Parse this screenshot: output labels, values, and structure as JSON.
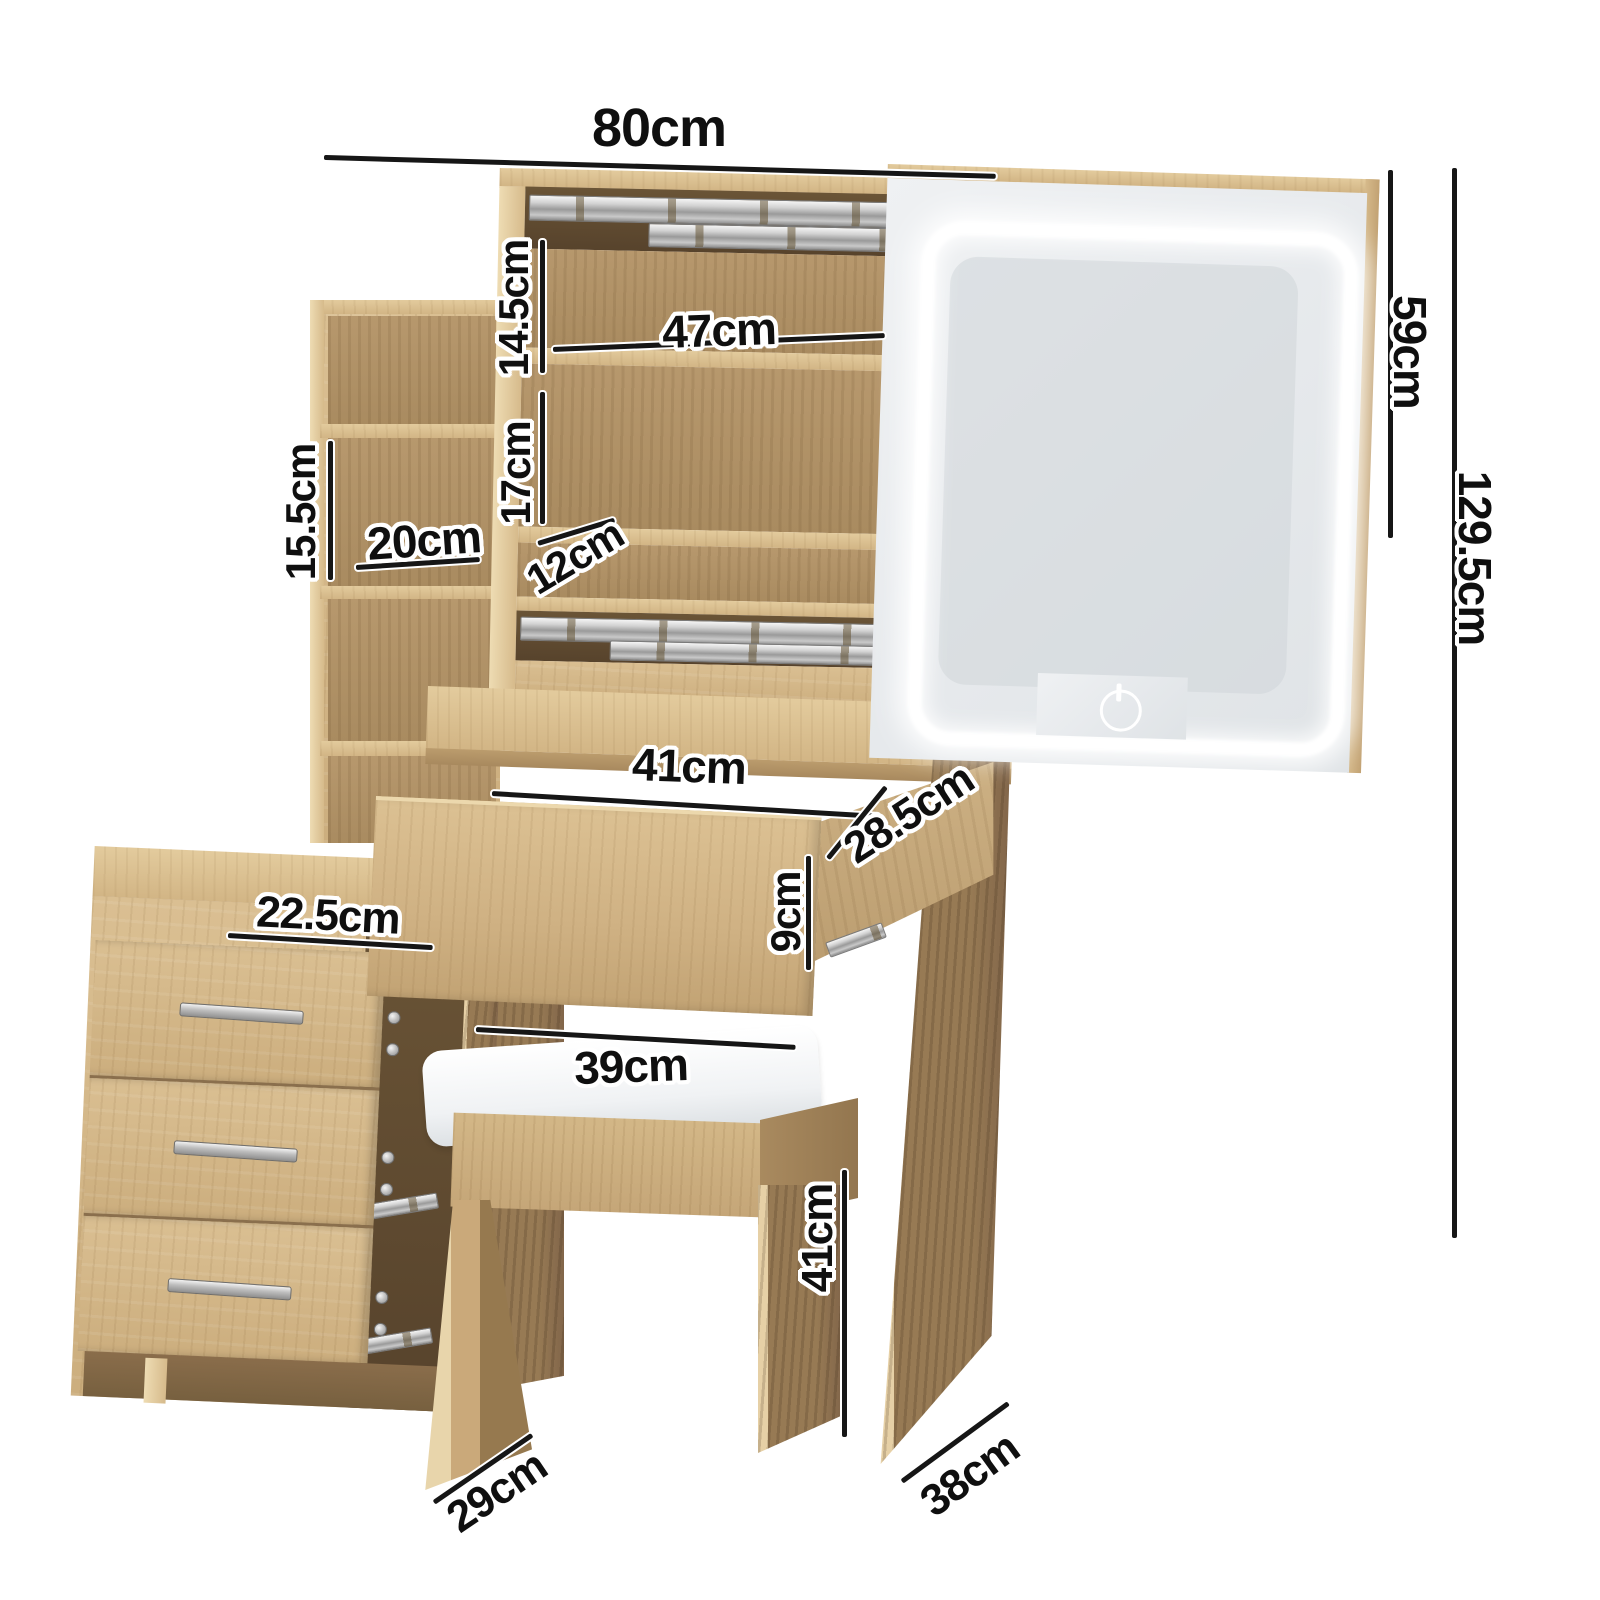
{
  "product": {
    "name": "dressing table with LED mirror, hutch shelves, drawers and stool dimension diagram"
  },
  "dimensions": {
    "hutch_width": "80cm",
    "shelf_inner_width": "47cm",
    "top_shelf_height": "14.5cm",
    "middle_shelf_height": "17cm",
    "shelf_depth": "12cm",
    "tower_shelf_height": "15.5cm",
    "tower_width": "20cm",
    "mirror_height": "59cm",
    "total_height": "129.5cm",
    "drawer_width": "41cm",
    "drawer_depth": "28.5cm",
    "drawer_height": "9cm",
    "side_drawer_width": "22.5cm",
    "stool_seat_width": "39cm",
    "stool_height": "41cm",
    "stool_depth": "29cm",
    "table_depth": "38cm"
  },
  "icons": {
    "power_button": "power-icon"
  },
  "palette": {
    "wood_light": "#dabf92",
    "wood_mid": "#c9aa7a",
    "wood_dark": "#86694b",
    "interior_dark": "#5d4930",
    "metal": "#bfbfbf",
    "mirror_face": "#e9ebed",
    "led": "#ffffff",
    "label_text": "#0f0f0f",
    "label_outline": "#ffffff",
    "background": "#ffffff"
  }
}
